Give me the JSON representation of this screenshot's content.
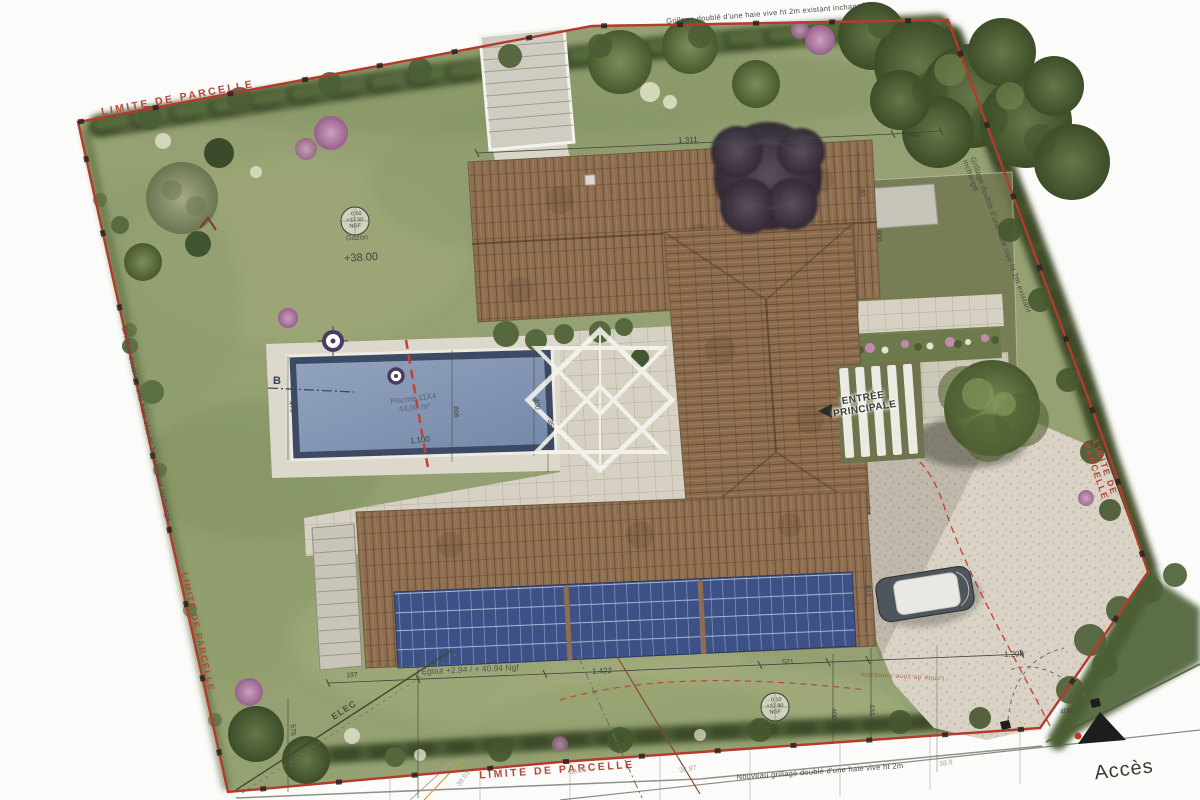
{
  "colors": {
    "boundary_red": "#b23b2b",
    "roof_tile": "#8d6e51",
    "solar_panel_blue": "#3e5186",
    "pool_water": "#8397b4",
    "lawn_green": "#95a173",
    "hedge_green": "#4c5e36",
    "gravel_beige": "#d9d2c5",
    "paper_white": "#fbfbf9"
  },
  "labels": [
    {
      "name": "limite-parcelle-top",
      "text": "LIMITE DE PARCELLE",
      "x": 178,
      "y": 99,
      "rot": -10.5,
      "cls": "red"
    },
    {
      "name": "limite-parcelle-left",
      "text": "LIMITE DE PARCELLE",
      "x": 198,
      "y": 632,
      "rot": 77,
      "cls": "red-sm"
    },
    {
      "name": "limite-parcelle-right",
      "text": "LIMITE DE PARCELLE",
      "x": 1106,
      "y": 486,
      "rot": 71,
      "cls": "red-sm"
    },
    {
      "name": "limite-parcelle-bottom",
      "text": "LIMITE DE PARCELLE",
      "x": 557,
      "y": 771,
      "rot": -4,
      "cls": "red"
    },
    {
      "name": "fence-top",
      "text": "Grillage doublé d'une haie vive ht 2m existant inchangé",
      "x": 766,
      "y": 14,
      "rot": -4.5,
      "cls": "fence"
    },
    {
      "name": "fence-left",
      "text": "Grillage doublé d'une haie vive ht 2m existant inchangé",
      "x": 146,
      "y": 424,
      "rot": 77,
      "cls": "fence"
    },
    {
      "name": "fence-right",
      "text": "Grillage doublé d'une haie vive ht 2m existant inchangé",
      "x": 1002,
      "y": 252,
      "rot": 70,
      "cls": "fence"
    },
    {
      "name": "fence-bottom-new",
      "text": "Nouveau grillage doublé d'une haie vive ht 2m",
      "x": 820,
      "y": 772,
      "rot": -4,
      "cls": "fence"
    },
    {
      "name": "acces-label",
      "text": "Accès",
      "x": 1124,
      "y": 770,
      "rot": -7,
      "cls": "acces"
    },
    {
      "name": "acces-dim-400",
      "text": "400",
      "x": 1066,
      "y": 712,
      "rot": -8,
      "cls": "dim"
    },
    {
      "name": "entree-principale-label",
      "text": "ENTRÉE\nPRINCIPALE",
      "x": 864,
      "y": 404,
      "rot": -9,
      "cls": "entree"
    },
    {
      "name": "pool-label",
      "text": "Piscine 11X4\n44,00 m²",
      "x": 414,
      "y": 404,
      "rot": -7,
      "cls": "pool"
    },
    {
      "name": "dim-1100",
      "text": "1.100",
      "x": 420,
      "y": 441,
      "rot": -6,
      "cls": "dim8"
    },
    {
      "name": "dim-470",
      "text": "470",
      "x": 291,
      "y": 407,
      "rot": 84,
      "cls": "dim"
    },
    {
      "name": "dim-896",
      "text": "896",
      "x": 455,
      "y": 412,
      "rot": 86,
      "cls": "dim"
    },
    {
      "name": "dim-400-pool",
      "text": "400",
      "x": 536,
      "y": 404,
      "rot": 84,
      "cls": "dim"
    },
    {
      "name": "dim-357",
      "text": "357",
      "x": 550,
      "y": 425,
      "rot": 84,
      "cls": "dim"
    },
    {
      "name": "level-plus-38",
      "text": "+38.00",
      "x": 361,
      "y": 258,
      "rot": -3,
      "cls": "level"
    },
    {
      "name": "gazon-label",
      "text": "Gazon",
      "x": 357,
      "y": 238,
      "rot": -3,
      "cls": "gray7"
    },
    {
      "name": "survey-marker-1",
      "text": "- 0.50\n+37.50\nNGF",
      "x": 355,
      "y": 221,
      "rot": -3,
      "cls": "marker"
    },
    {
      "name": "survey-marker-2",
      "text": "- 0.10\n+37.90\nNGF",
      "x": 775,
      "y": 707,
      "rot": -3,
      "cls": "marker"
    },
    {
      "name": "dim-1311",
      "text": "1.311",
      "x": 688,
      "y": 141,
      "rot": -3,
      "cls": "dim8"
    },
    {
      "name": "dim-445",
      "text": "445",
      "x": 914,
      "y": 136,
      "rot": -3,
      "cls": "dim"
    },
    {
      "name": "dim-82",
      "text": "82",
      "x": 861,
      "y": 193,
      "rot": 87,
      "cls": "dim"
    },
    {
      "name": "dim-600",
      "text": "600",
      "x": 878,
      "y": 236,
      "rot": 87,
      "cls": "dim"
    },
    {
      "name": "dim-612",
      "text": "612",
      "x": 867,
      "y": 591,
      "rot": 87,
      "cls": "dim"
    },
    {
      "name": "dim-197",
      "text": "197",
      "x": 352,
      "y": 676,
      "rot": -3,
      "cls": "dim"
    },
    {
      "name": "egout-label",
      "text": "Egout +2.94 / + 40.94 Ngf",
      "x": 470,
      "y": 670,
      "rot": -2.5,
      "cls": "gray"
    },
    {
      "name": "dim-1422",
      "text": "1.422",
      "x": 602,
      "y": 672,
      "rot": -3,
      "cls": "dim8"
    },
    {
      "name": "dim-521",
      "text": "521",
      "x": 788,
      "y": 663,
      "rot": -3,
      "cls": "dim"
    },
    {
      "name": "dim-1208",
      "text": "1.208",
      "x": 1014,
      "y": 655,
      "rot": -3,
      "cls": "dim8"
    },
    {
      "name": "dim-400-bottom",
      "text": "400",
      "x": 833,
      "y": 714,
      "rot": 87,
      "cls": "dim"
    },
    {
      "name": "dim-431",
      "text": "431",
      "x": 871,
      "y": 710,
      "rot": 87,
      "cls": "dim"
    },
    {
      "name": "dim-575",
      "text": "575",
      "x": 292,
      "y": 730,
      "rot": 87,
      "cls": "dim"
    },
    {
      "name": "elec-label",
      "text": "ELEC",
      "x": 344,
      "y": 710,
      "rot": -33,
      "cls": "elec"
    },
    {
      "name": "flood-annotation",
      "text": "Limite de zone inondable",
      "x": 902,
      "y": 676,
      "rot": 183,
      "cls": "redannot"
    },
    {
      "name": "section-b-label",
      "text": "B",
      "x": 277,
      "y": 381,
      "rot": 0,
      "cls": "b"
    },
    {
      "name": "spot-level-3901",
      "text": "39.01",
      "x": 464,
      "y": 779,
      "rot": -55,
      "cls": "faint"
    },
    {
      "name": "spot-level-3896",
      "text": "38.96",
      "x": 578,
      "y": 772,
      "rot": -10,
      "cls": "faint"
    },
    {
      "name": "spot-level-3897",
      "text": "38.97",
      "x": 688,
      "y": 770,
      "rot": -10,
      "cls": "faint"
    },
    {
      "name": "spot-level-389",
      "text": "38.9",
      "x": 946,
      "y": 764,
      "rot": -10,
      "cls": "faint"
    }
  ]
}
